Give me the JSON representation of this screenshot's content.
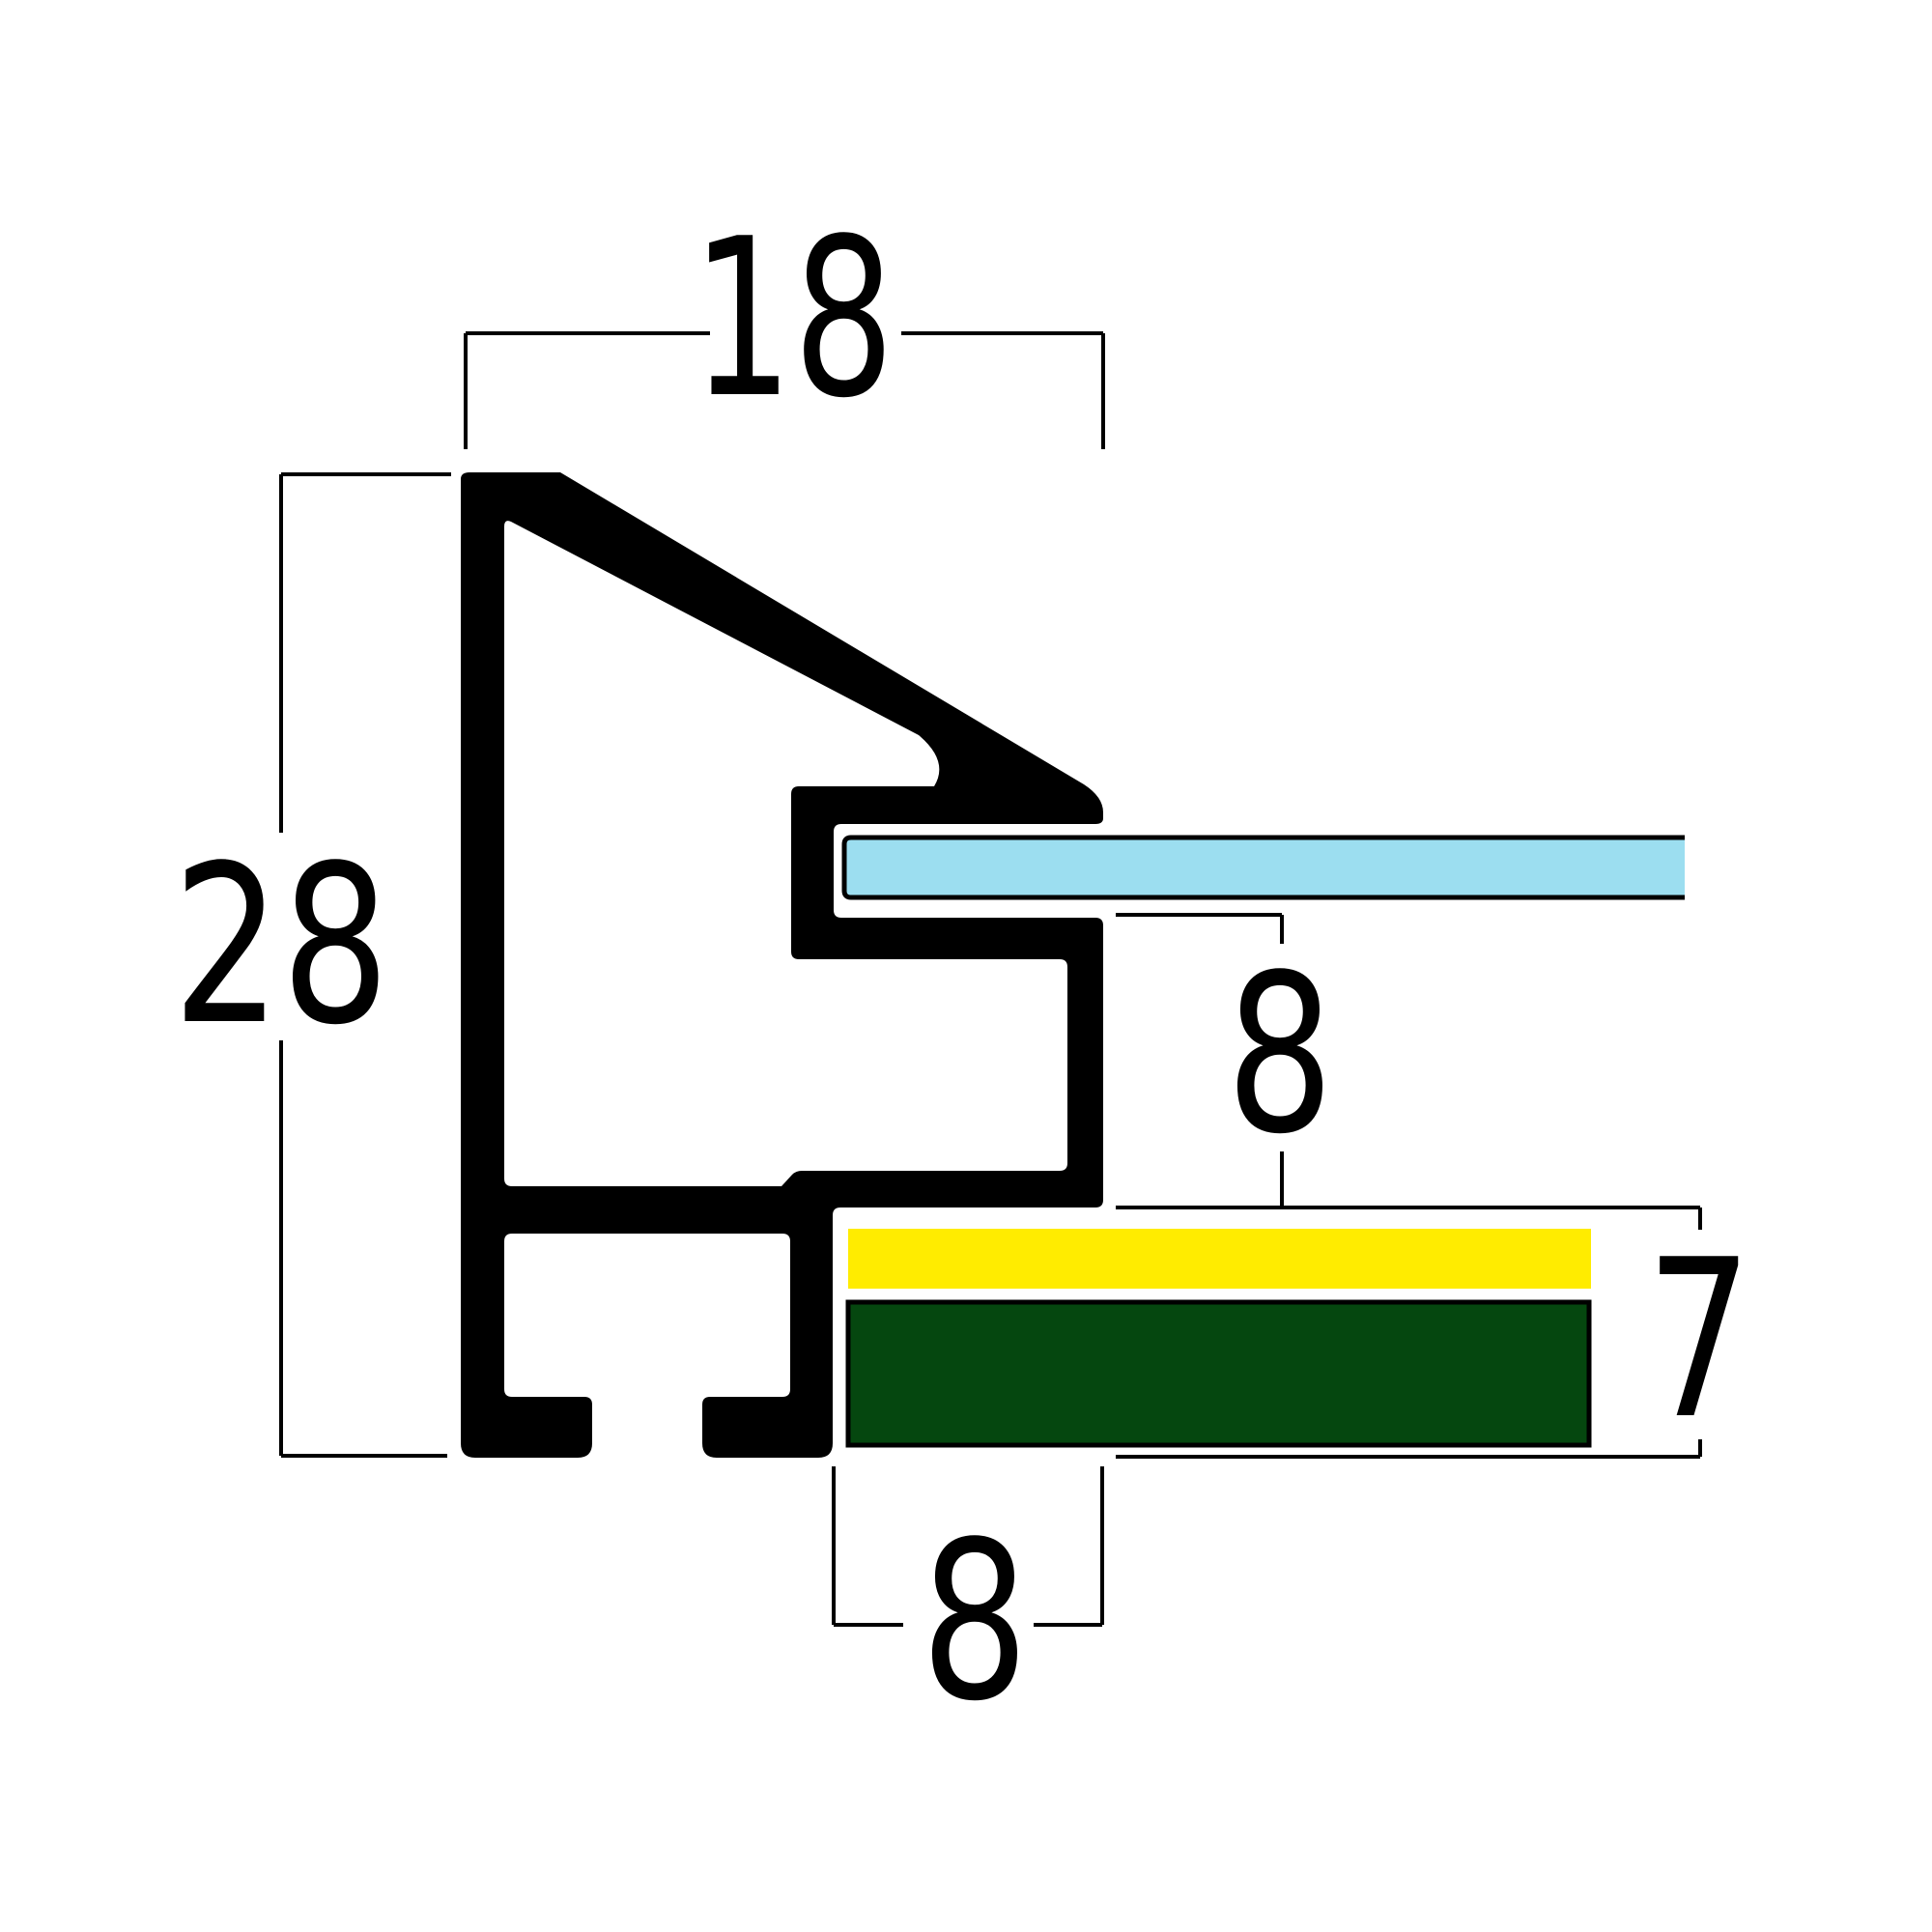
{
  "diagram": {
    "type": "cross-section",
    "subject": "picture frame moulding profile with glazing and backing stack",
    "background_color": "#FFFFFF",
    "line_color": "#000000",
    "dimensions": {
      "top_width": "18",
      "left_height": "28",
      "rabbet_depth": "8",
      "right_stack_thickness": "7",
      "bottom_foot_width": "8"
    },
    "layers": {
      "profile_color": "#000000",
      "glass_color": "#9CDEF0",
      "mat_color": "#FFEC00",
      "backing_color": "#05470F"
    }
  }
}
